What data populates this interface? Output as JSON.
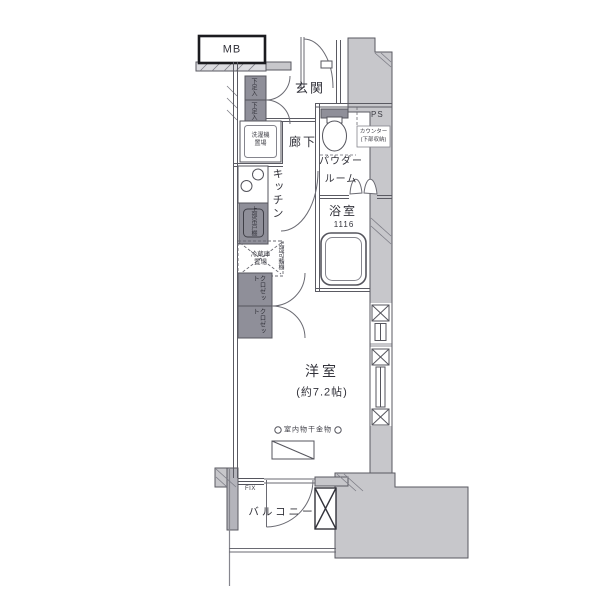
{
  "labels": {
    "mb": "MB",
    "entrance": "玄関",
    "hallway": "廊下",
    "shoe_cabinet_upper": "下足入",
    "shoe_cabinet_lower": "下足入",
    "washing_machine": "洗濯機置場",
    "kitchen": "キッチン",
    "kitchen_upper_cabinet": "上部吊戸棚",
    "refrigerator": "冷蔵庫置場",
    "upper_shelf": "上部可動棚",
    "pipe_space": "PS",
    "counter_note": "カウンター(下部収納)",
    "powder_room": "パウダールーム",
    "bathroom": "浴室",
    "bathroom_size": "1116",
    "closet_upper": "クロゼット",
    "closet_lower": "クロゼット",
    "western_room": "洋室",
    "western_room_size": "(約7.2帖)",
    "indoor_laundry_hardware": "室内物干金物",
    "fix_window": "FIX",
    "balcony": "バルコニー"
  },
  "colors": {
    "wall_fill": "#c7c7cb",
    "fixture_fill": "#8f8f99",
    "line": "#5a5a62",
    "mb_border": "#1b1b1f",
    "background": "#ffffff"
  }
}
